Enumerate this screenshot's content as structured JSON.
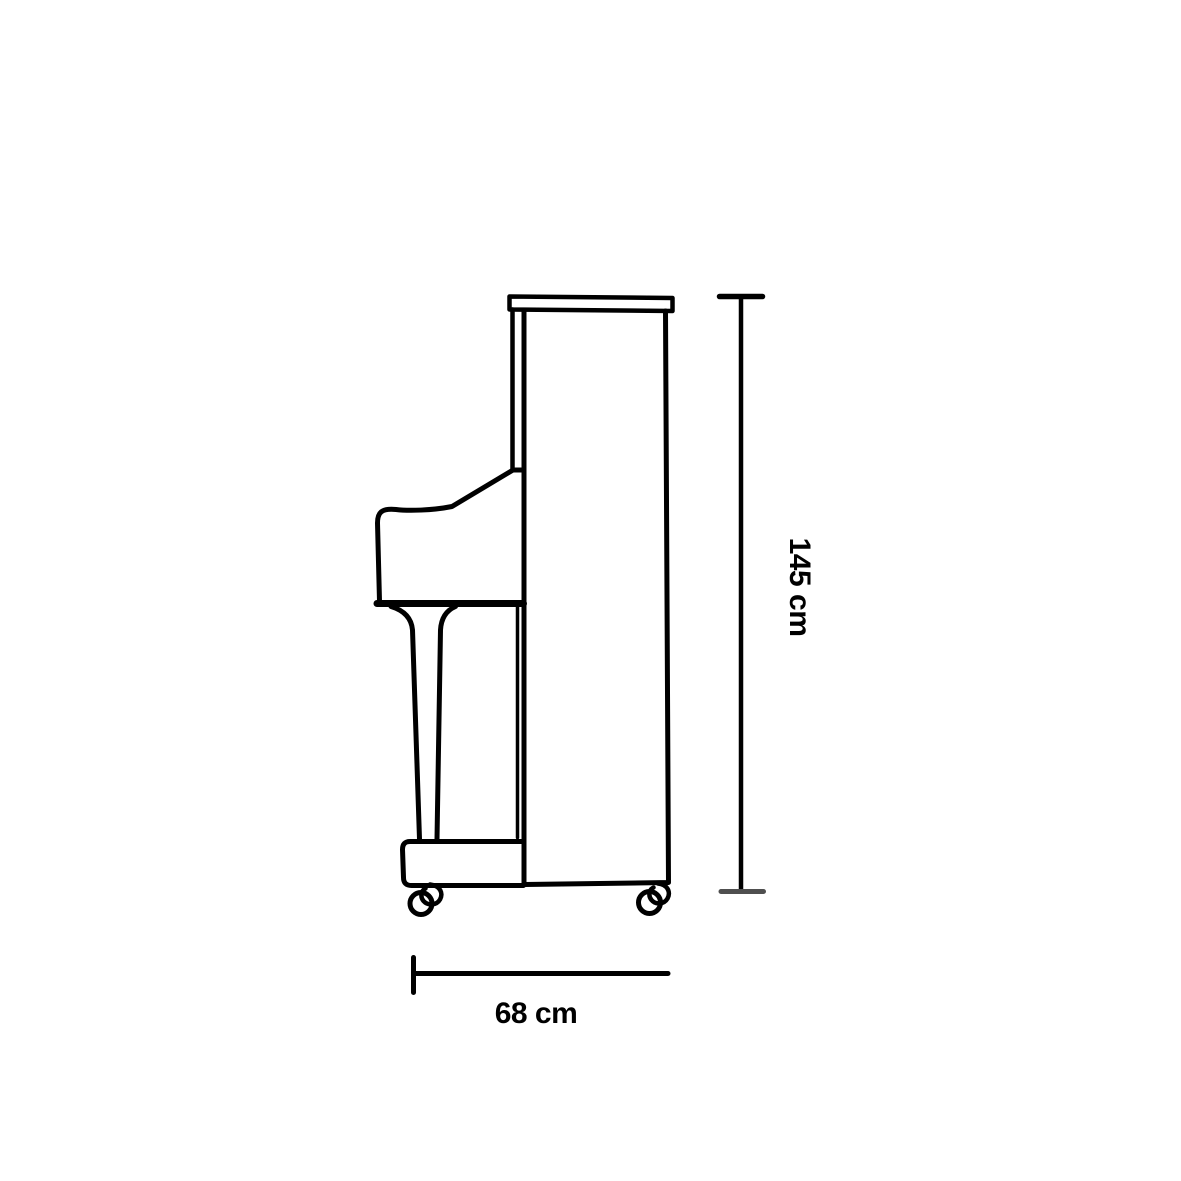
{
  "page": {
    "background_color": "#ffffff",
    "line_color": "#000000",
    "muted_tick_color": "#4f4f4f"
  },
  "illustration": {
    "name": "upright-piano-side-view-line-drawing"
  },
  "dimensions": {
    "height": {
      "label": "145 cm"
    },
    "depth": {
      "label": "68 cm"
    }
  }
}
